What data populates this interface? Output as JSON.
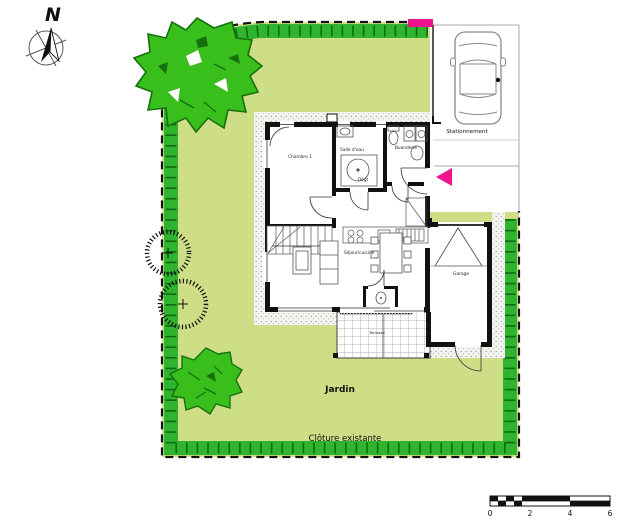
{
  "compass": {
    "north_label": "N"
  },
  "site": {
    "jardin_label": "Jardin",
    "cloture_label": "Clôture existante",
    "stationnement_label": "Stationnement"
  },
  "rooms": {
    "chambre": "Chambre 1",
    "salle_eau": "Salle d'eau",
    "buanderie": "Buanderie",
    "degagement": "Dégt",
    "sejour": "Séjour/cuisine",
    "garage": "Garage",
    "terrasse": "Terrasse"
  },
  "scale_bar": {
    "ticks": [
      "0",
      "2",
      "4",
      "6"
    ]
  },
  "colors": {
    "garden": "#cdde87",
    "hedge": "#2fb42f",
    "hedge_dark": "#0f6b12",
    "tree": "#38bf1b",
    "tree_dark": "#17700e",
    "accent_magenta": "#f0138e"
  }
}
